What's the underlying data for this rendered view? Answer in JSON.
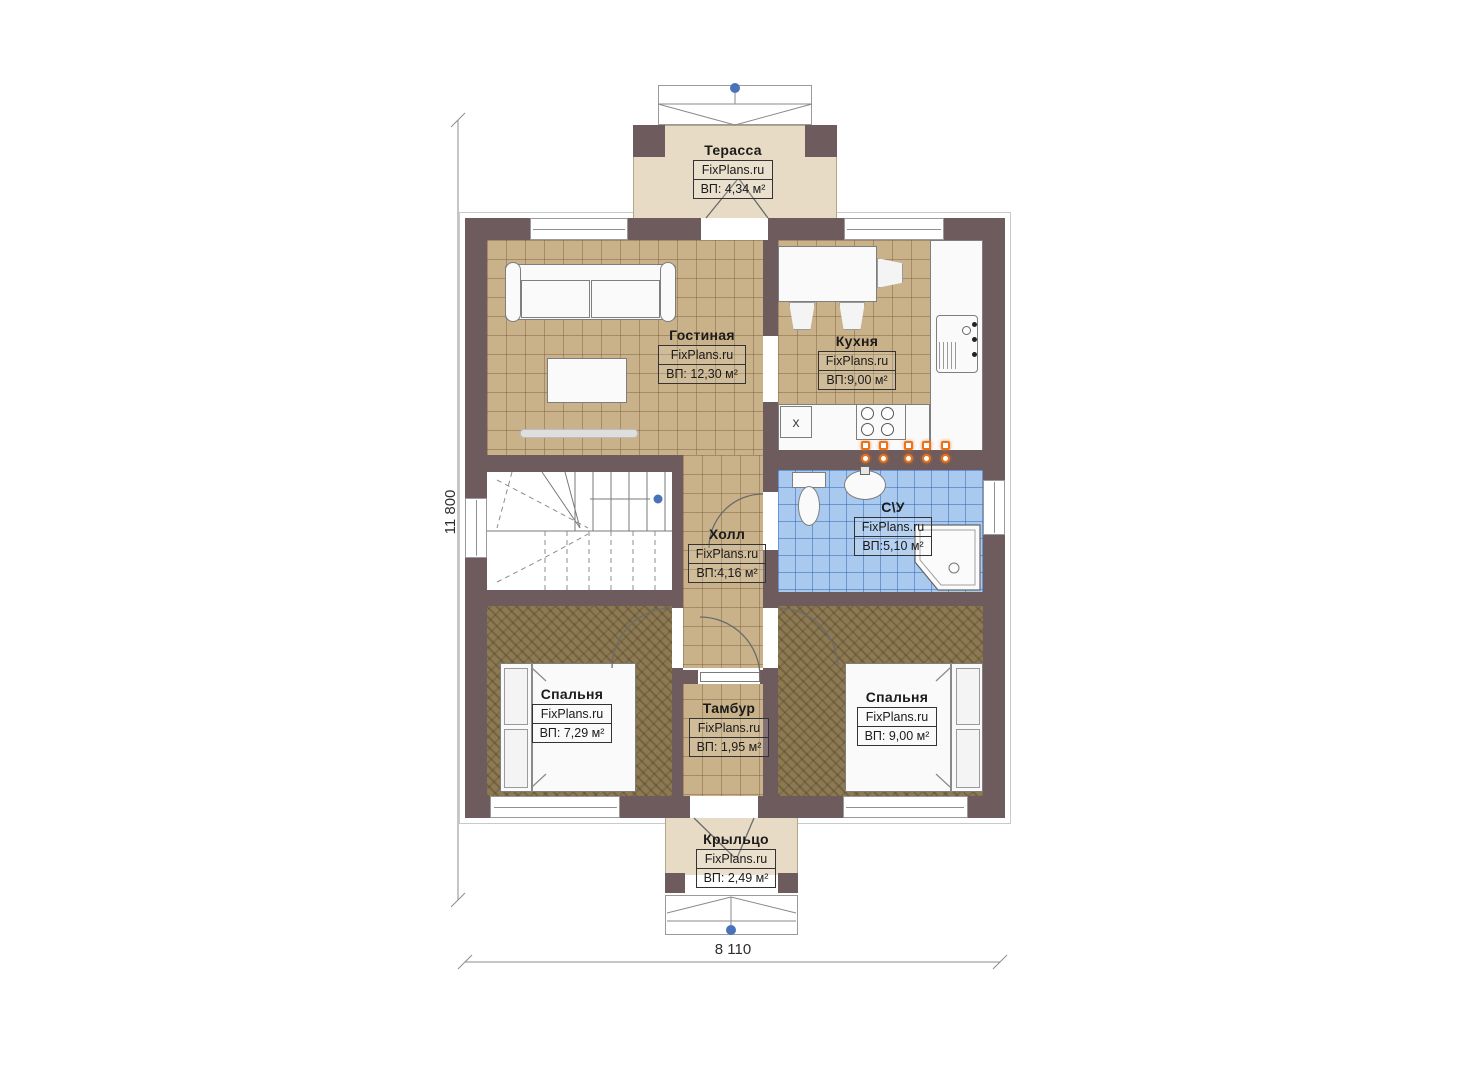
{
  "plan": {
    "site_watermark": "FixPlans.ru",
    "rooms": [
      {
        "name": "Терасса",
        "brand": "FixPlans.ru",
        "area": "ВП: 4,34 м²"
      },
      {
        "name": "Гостиная",
        "brand": "FixPlans.ru",
        "area": "ВП: 12,30 м²"
      },
      {
        "name": "Кухня",
        "brand": "FixPlans.ru",
        "area": "ВП:9,00 м²"
      },
      {
        "name": "Холл",
        "brand": "FixPlans.ru",
        "area": "ВП:4,16 м²"
      },
      {
        "name": "С\\У",
        "brand": "FixPlans.ru",
        "area": "ВП:5,10 м²"
      },
      {
        "name": "Спальня",
        "brand": "FixPlans.ru",
        "area": "ВП: 7,29 м²"
      },
      {
        "name": "Тамбур",
        "brand": "FixPlans.ru",
        "area": "ВП: 1,95 м²"
      },
      {
        "name": "Спальня",
        "brand": "FixPlans.ru",
        "area": "ВП: 9,00 м²"
      },
      {
        "name": "Крыльцо",
        "brand": "FixPlans.ru",
        "area": "ВП: 2,49 м²"
      }
    ],
    "dimensions": {
      "height": "11 800",
      "width": "8 110"
    },
    "markers": {
      "kitchen_appliance": "х"
    },
    "colors": {
      "wall": "#6e5b5d",
      "floor_tan": "#c9b189",
      "floor_beige": "#e7dbc5",
      "floor_khaki": "#8d7a53",
      "floor_blue": "#aac9ee",
      "accent_orange": "#e8731e",
      "marker_blue": "#4a72b8"
    }
  }
}
